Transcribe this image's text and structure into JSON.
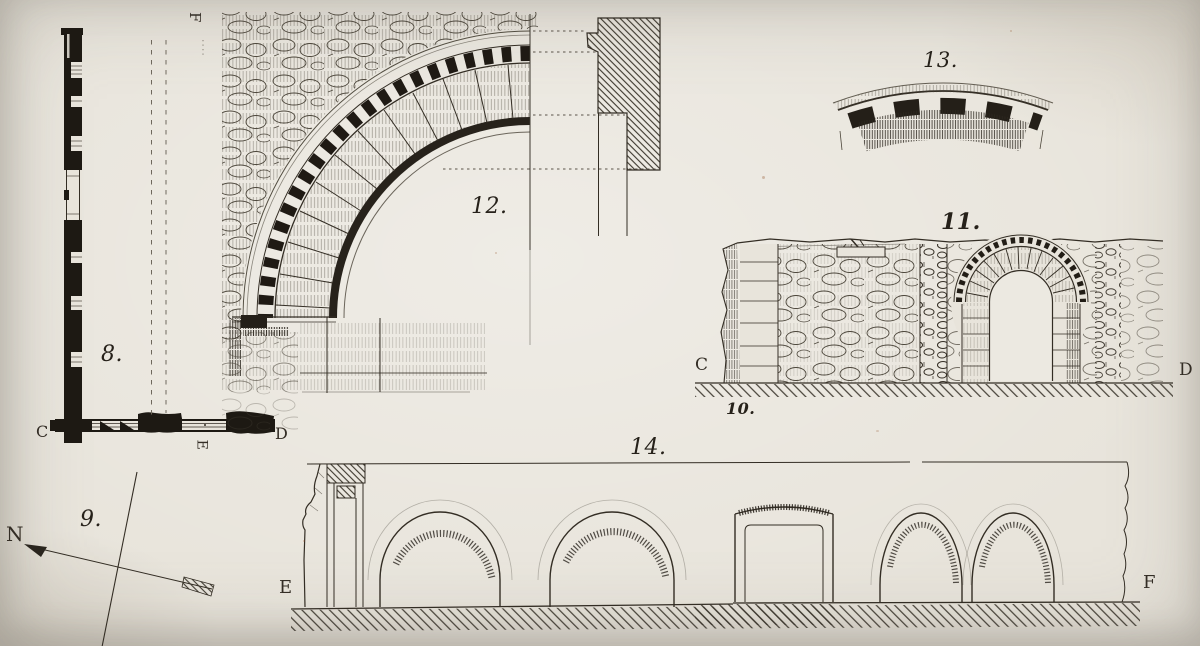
{
  "figures": {
    "fig8": {
      "label": "8.",
      "letters": {
        "top": "F",
        "left": "C",
        "right": "D",
        "bottom": "E"
      }
    },
    "fig9": {
      "label": "9.",
      "letters": {
        "north": "N"
      }
    },
    "fig10": {
      "label": "10."
    },
    "fig11": {
      "label": "11.",
      "letters": {
        "left": "C",
        "right": "D"
      }
    },
    "fig12": {
      "label": "12."
    },
    "fig13": {
      "label": "13."
    },
    "fig14": {
      "label": "14.",
      "letters": {
        "left": "E",
        "right": "F"
      }
    }
  },
  "palette": {
    "paper": "#e8e4db",
    "ink": "#332d24",
    "ink_dark": "#1d1913"
  }
}
